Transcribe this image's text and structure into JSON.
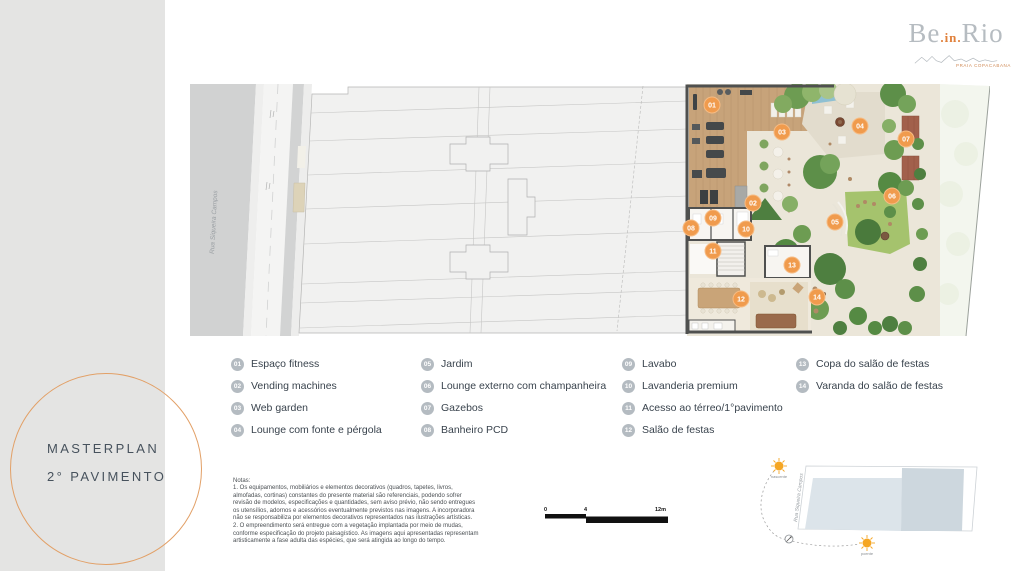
{
  "sidebar": {
    "title_line1": "MASTERPLAN",
    "title_line2": "2° PAVIMENTO"
  },
  "logo": {
    "word1": "Be",
    "word2": ".in.",
    "word3": "Rio",
    "tagline": "PRAIA COPACABANA"
  },
  "plan": {
    "street_label": "Rua Siqueira Campos",
    "markers": [
      {
        "num": "01",
        "x": 522,
        "y": 21
      },
      {
        "num": "02",
        "x": 563,
        "y": 119
      },
      {
        "num": "03",
        "x": 592,
        "y": 48
      },
      {
        "num": "04",
        "x": 670,
        "y": 42
      },
      {
        "num": "05",
        "x": 645,
        "y": 138
      },
      {
        "num": "06",
        "x": 702,
        "y": 112
      },
      {
        "num": "07",
        "x": 716,
        "y": 55
      },
      {
        "num": "08",
        "x": 501,
        "y": 144
      },
      {
        "num": "09",
        "x": 523,
        "y": 134
      },
      {
        "num": "10",
        "x": 556,
        "y": 145
      },
      {
        "num": "11",
        "x": 523,
        "y": 167
      },
      {
        "num": "12",
        "x": 551,
        "y": 215
      },
      {
        "num": "13",
        "x": 602,
        "y": 181
      },
      {
        "num": "14",
        "x": 627,
        "y": 213
      }
    ]
  },
  "legend": {
    "items": [
      {
        "num": "01",
        "label": "Espaço fitness",
        "col": 0
      },
      {
        "num": "02",
        "label": "Vending machines",
        "col": 0
      },
      {
        "num": "03",
        "label": "Web garden",
        "col": 0
      },
      {
        "num": "04",
        "label": "Lounge com fonte e pérgola",
        "col": 0
      },
      {
        "num": "05",
        "label": "Jardim",
        "col": 1
      },
      {
        "num": "06",
        "label": "Lounge externo com champanheira",
        "col": 1
      },
      {
        "num": "07",
        "label": "Gazebos",
        "col": 1
      },
      {
        "num": "08",
        "label": "Banheiro PCD",
        "col": 1
      },
      {
        "num": "09",
        "label": "Lavabo",
        "col": 2
      },
      {
        "num": "10",
        "label": "Lavanderia premium",
        "col": 2
      },
      {
        "num": "11",
        "label": "Acesso ao térreo/1°pavimento",
        "col": 2
      },
      {
        "num": "12",
        "label": "Salão de festas",
        "col": 2
      },
      {
        "num": "13",
        "label": "Copa do salão de festas",
        "col": 3
      },
      {
        "num": "14",
        "label": "Varanda do salão de festas",
        "col": 3
      }
    ]
  },
  "notes": {
    "title": "Notas:",
    "lines": [
      "1. Os equipamentos, mobiliários e elementos decorativos (quadros, tapetes, livros,",
      "almofadas, cortinas) constantes do presente material são referenciais, podendo sofrer",
      "revisão de modelos, especificações e quantidades, sem aviso prévio, não sendo entregues",
      "os utensílios, adornos e acessórios eventualmente previstos nas imagens. A incorporadora",
      "não se responsabiliza por elementos decorativos representados nas ilustrações artísticas.",
      "2. O empreendimento será entregue com a vegetação implantada por meio de mudas,",
      "conforme especificação do projeto paisagístico. As imagens aqui apresentadas representam",
      "artisticamente a fase adulta das espécies, que será atingida ao longo do tempo."
    ]
  },
  "scalebar": {
    "zero": "0",
    "mid": "4",
    "end": "12m"
  },
  "sunpath": {
    "sunrise": "nascente",
    "sunset": "poente",
    "street_label": "Rua Siqueira Campos"
  },
  "colors": {
    "marker_orange": "#f09b4d",
    "marker_ring": "#f6bb83",
    "badge_gray": "#b4bbc1",
    "circle_orange": "#e2a067",
    "logo_orange": "#e0813c",
    "logo_gray": "#b6bcc1",
    "sun_yellow": "#f5a623"
  }
}
